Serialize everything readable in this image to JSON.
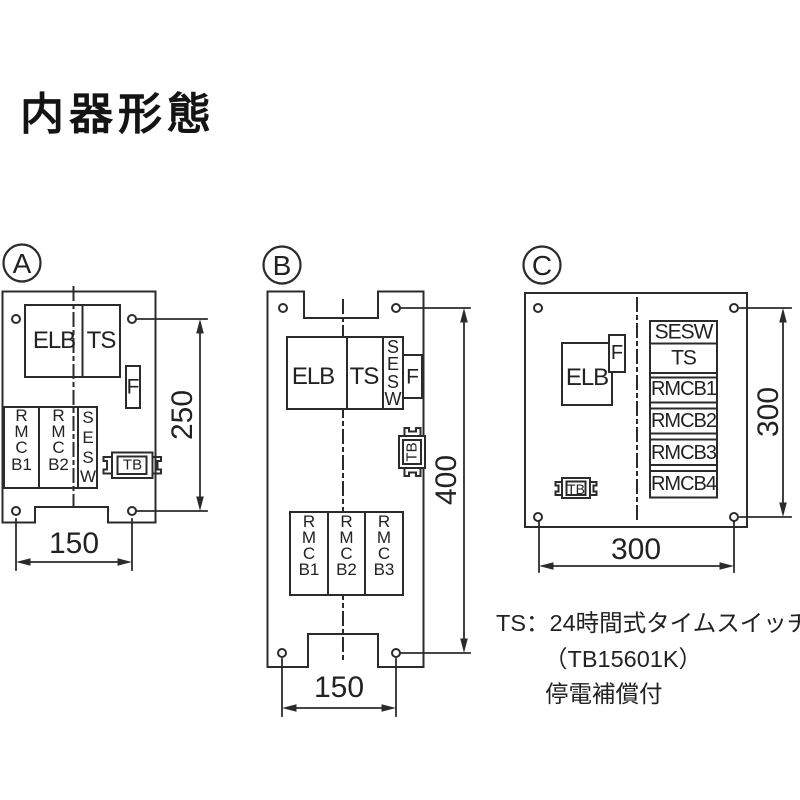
{
  "title": "内器形態",
  "colors": {
    "line": "#2b2b2b",
    "background": "#ffffff"
  },
  "panels": {
    "a": {
      "label": "A",
      "blocks": {
        "elb": "ELB",
        "ts": "TS",
        "f": "F",
        "rmcb1": "RMCB1",
        "rmcb2": "RMCB2",
        "sesw": "SESW",
        "tb": "TB"
      },
      "dims": {
        "height": "250",
        "width": "150"
      }
    },
    "b": {
      "label": "B",
      "blocks": {
        "elb": "ELB",
        "ts": "TS",
        "sesw": "SESW",
        "f": "F",
        "tb": "TB",
        "rmcb1": "RMCB1",
        "rmcb2": "RMCB2",
        "rmcb3": "RMCB3"
      },
      "dims": {
        "height": "400",
        "width": "150"
      }
    },
    "c": {
      "label": "C",
      "blocks": {
        "elb": "ELB",
        "f": "F",
        "tb": "TB",
        "sesw": "SESW",
        "ts": "TS",
        "rmcb1": "RMCB1",
        "rmcb2": "RMCB2",
        "rmcb3": "RMCB3",
        "rmcb4": "RMCB4"
      },
      "dims": {
        "height": "300",
        "width": "300"
      }
    }
  },
  "notes": {
    "line1": "TS：24時間式タイムスイッチ",
    "line2": "（TB15601K）",
    "line3": "停電補償付"
  }
}
